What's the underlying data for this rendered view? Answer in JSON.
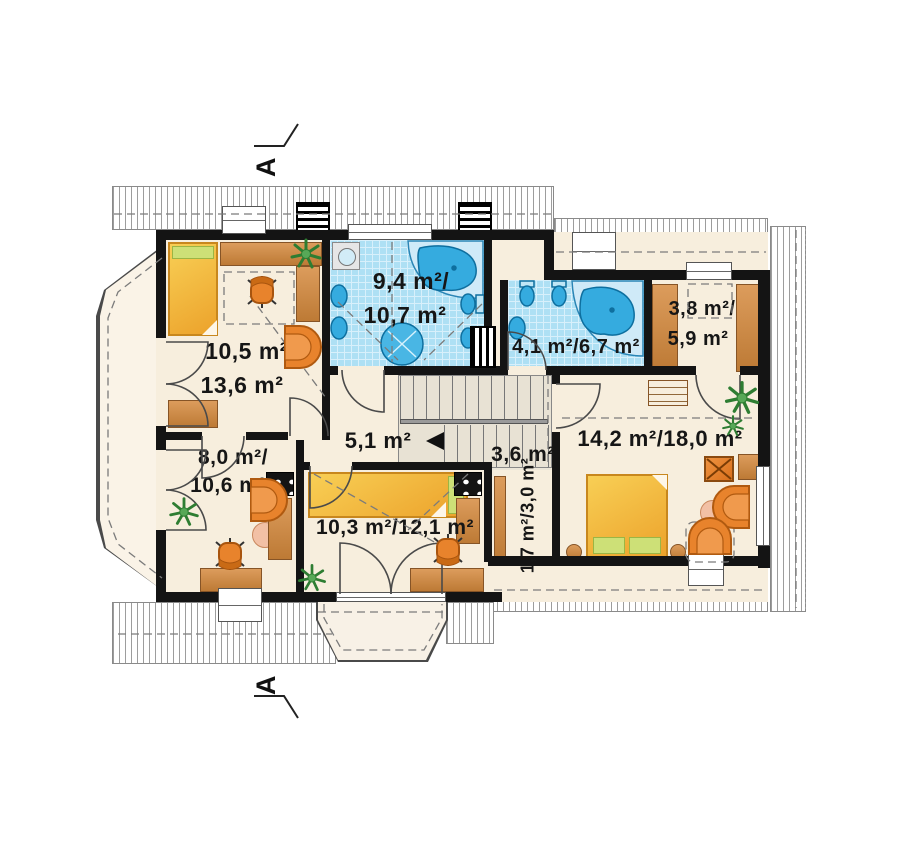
{
  "section_markers": {
    "top": "A",
    "bottom": "A"
  },
  "rooms": {
    "bedroom_topleft": {
      "line1": "10,5 m²/",
      "line2": "13,6 m²"
    },
    "bathroom_main": {
      "line1": "9,4 m²/",
      "line2": "10,7 m²"
    },
    "bathroom_small": {
      "label": "4,1 m²/6,7 m²"
    },
    "wardrobe": {
      "line1": "3,8 m²/",
      "line2": "5,9 m²"
    },
    "hall": {
      "label": "5,1 m²"
    },
    "stair_landing": {
      "label": "3,6 m²"
    },
    "corridor": {
      "label": "1,7 m²/3,0 m²"
    },
    "bedroom_right": {
      "label": "14,2 m²/18,0 m²"
    },
    "room_bottomleft": {
      "line1": "8,0 m²/",
      "line2": "10,6 m²"
    },
    "room_bottomcenter": {
      "label": "10,3 m²/12,1 m²"
    }
  },
  "colors": {
    "floor": "#f7eedd",
    "tile_blue": "#aee0f4",
    "fixture_blue": "#35abdf",
    "wall_black": "#141414",
    "furniture_orange": "#e8832c",
    "wood_brown": "#cd8c4a",
    "bed_yellow": "#f1b93d",
    "accent_green": "#cde077",
    "plant_green": "#2e7d32",
    "terrace_floor": "#faf3e7"
  }
}
